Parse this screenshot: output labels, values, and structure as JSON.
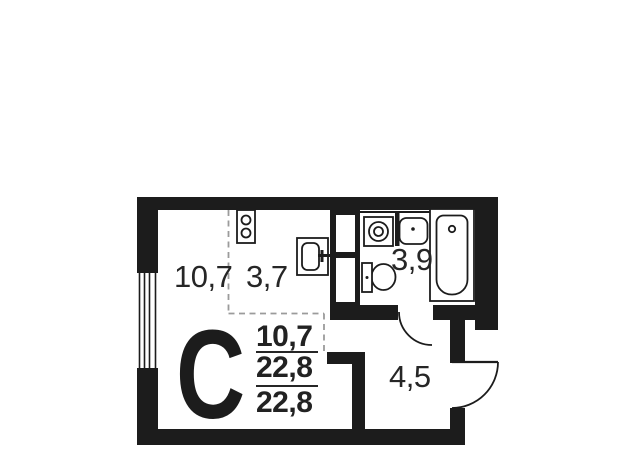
{
  "plan": {
    "studio_letter": "С",
    "labels": {
      "living_room_area": "10,7",
      "kitchen_zone_area": "3,7",
      "bathroom_area": "3,9",
      "hallway_area": "4,5"
    },
    "summary": {
      "living_area": "10,7",
      "total_area": "22,8",
      "reduced_total_area": "22,8"
    },
    "colors": {
      "wall": "#1c1c1c",
      "label_text": "#262626",
      "zone_dash": "#9b9b9b",
      "background": "#ffffff"
    }
  }
}
